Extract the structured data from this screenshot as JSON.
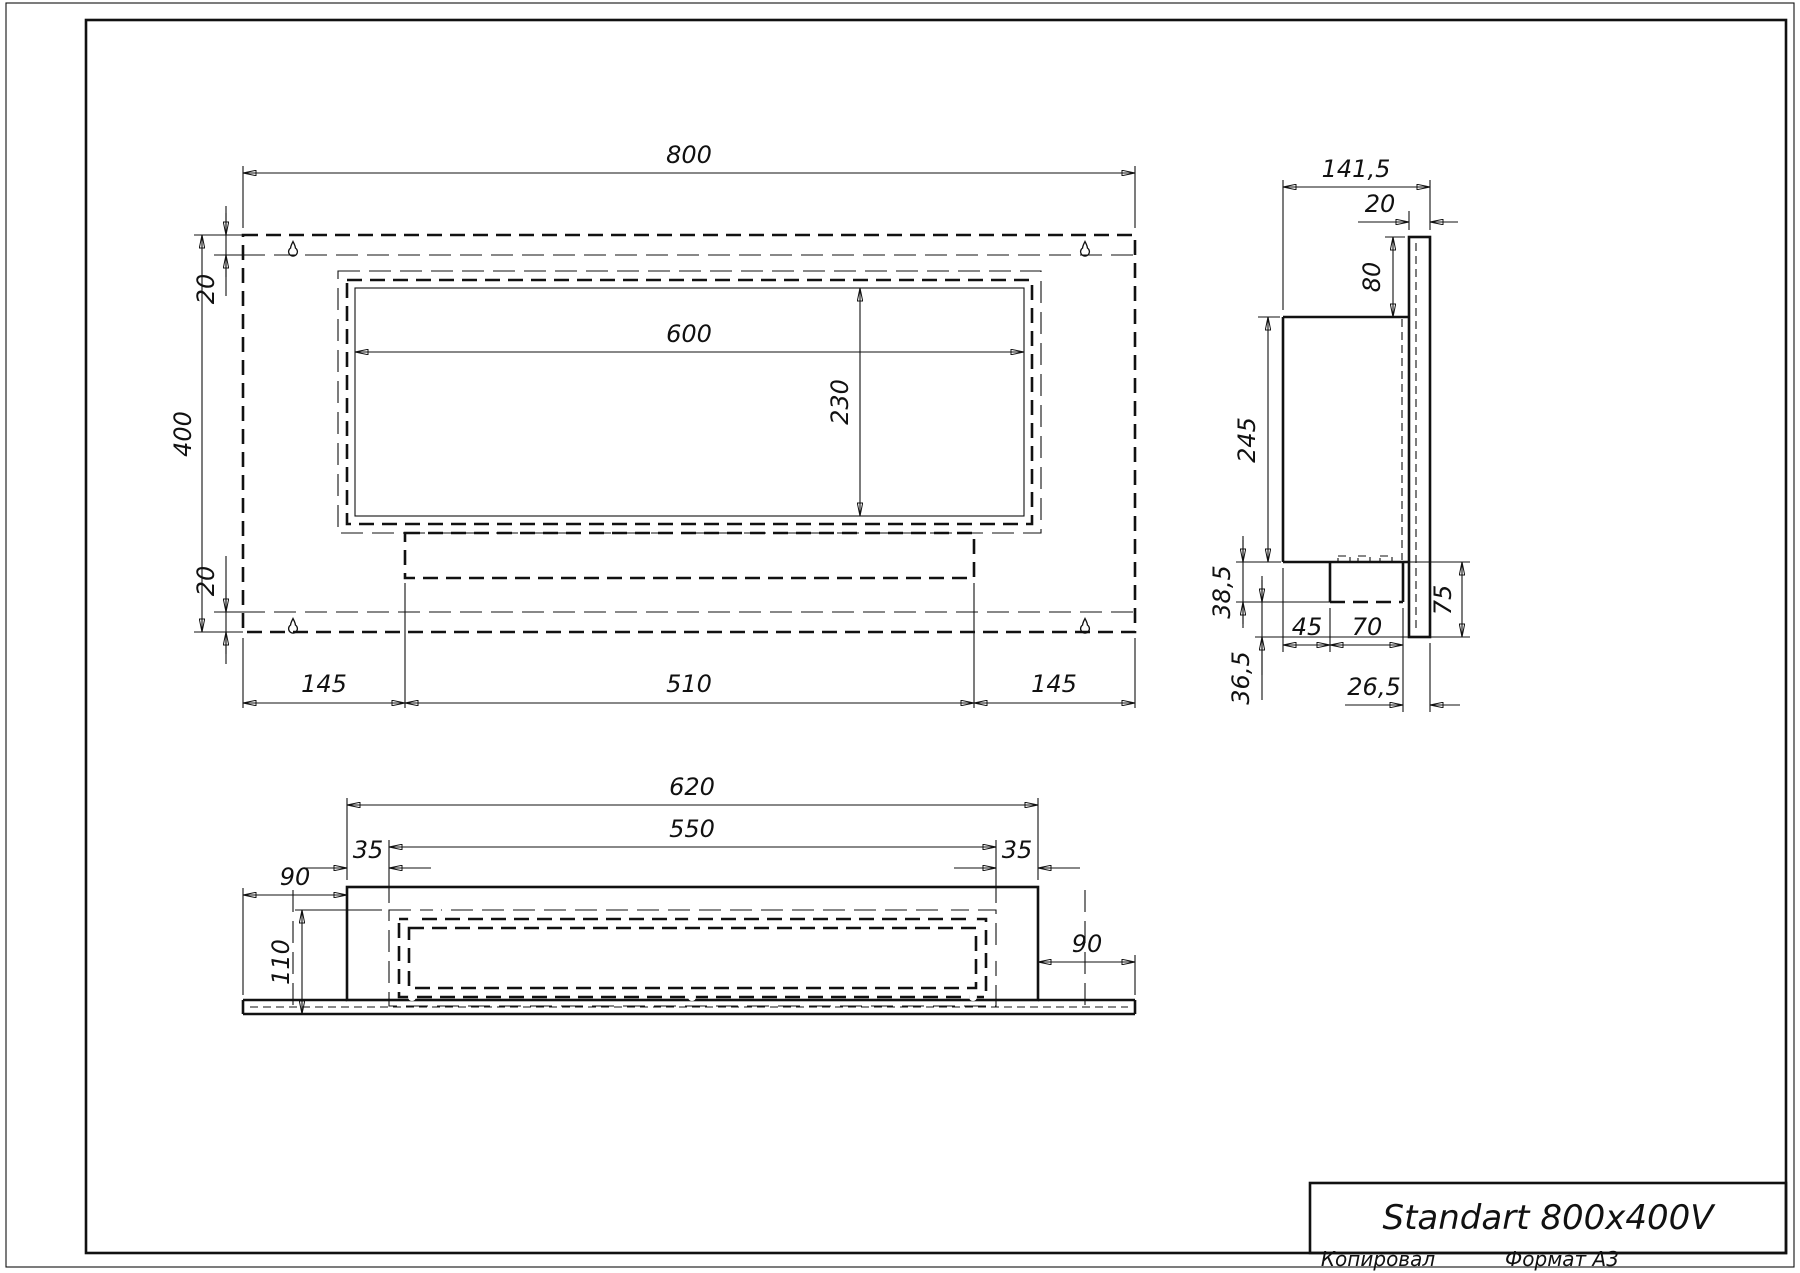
{
  "page": {
    "background": "#ffffff",
    "line_color": "#111111"
  },
  "title_block": {
    "title": "Standart 800x400V",
    "copied_label": "Копировал",
    "format_label": "Формат А3"
  },
  "front_view": {
    "dims": {
      "width": "800",
      "height": "400",
      "top_inset": "20",
      "bottom_inset": "20",
      "window_width": "600",
      "window_height": "230",
      "left_margin": "145",
      "burner_width": "510",
      "right_margin": "145"
    }
  },
  "side_view": {
    "dims": {
      "depth": "141,5",
      "plate_thickness": "20",
      "top_offset": "80",
      "body_height": "245",
      "shelf_height": "38,5",
      "channel_offset": "45",
      "channel_width": "70",
      "flange_height": "75",
      "bottom_offset": "36,5",
      "lip": "26,5"
    }
  },
  "bottom_view": {
    "dims": {
      "body_width": "620",
      "opening_width": "550",
      "left_inset": "35",
      "right_inset": "35",
      "left_overhang": "90",
      "right_overhang": "90",
      "depth": "110"
    }
  }
}
